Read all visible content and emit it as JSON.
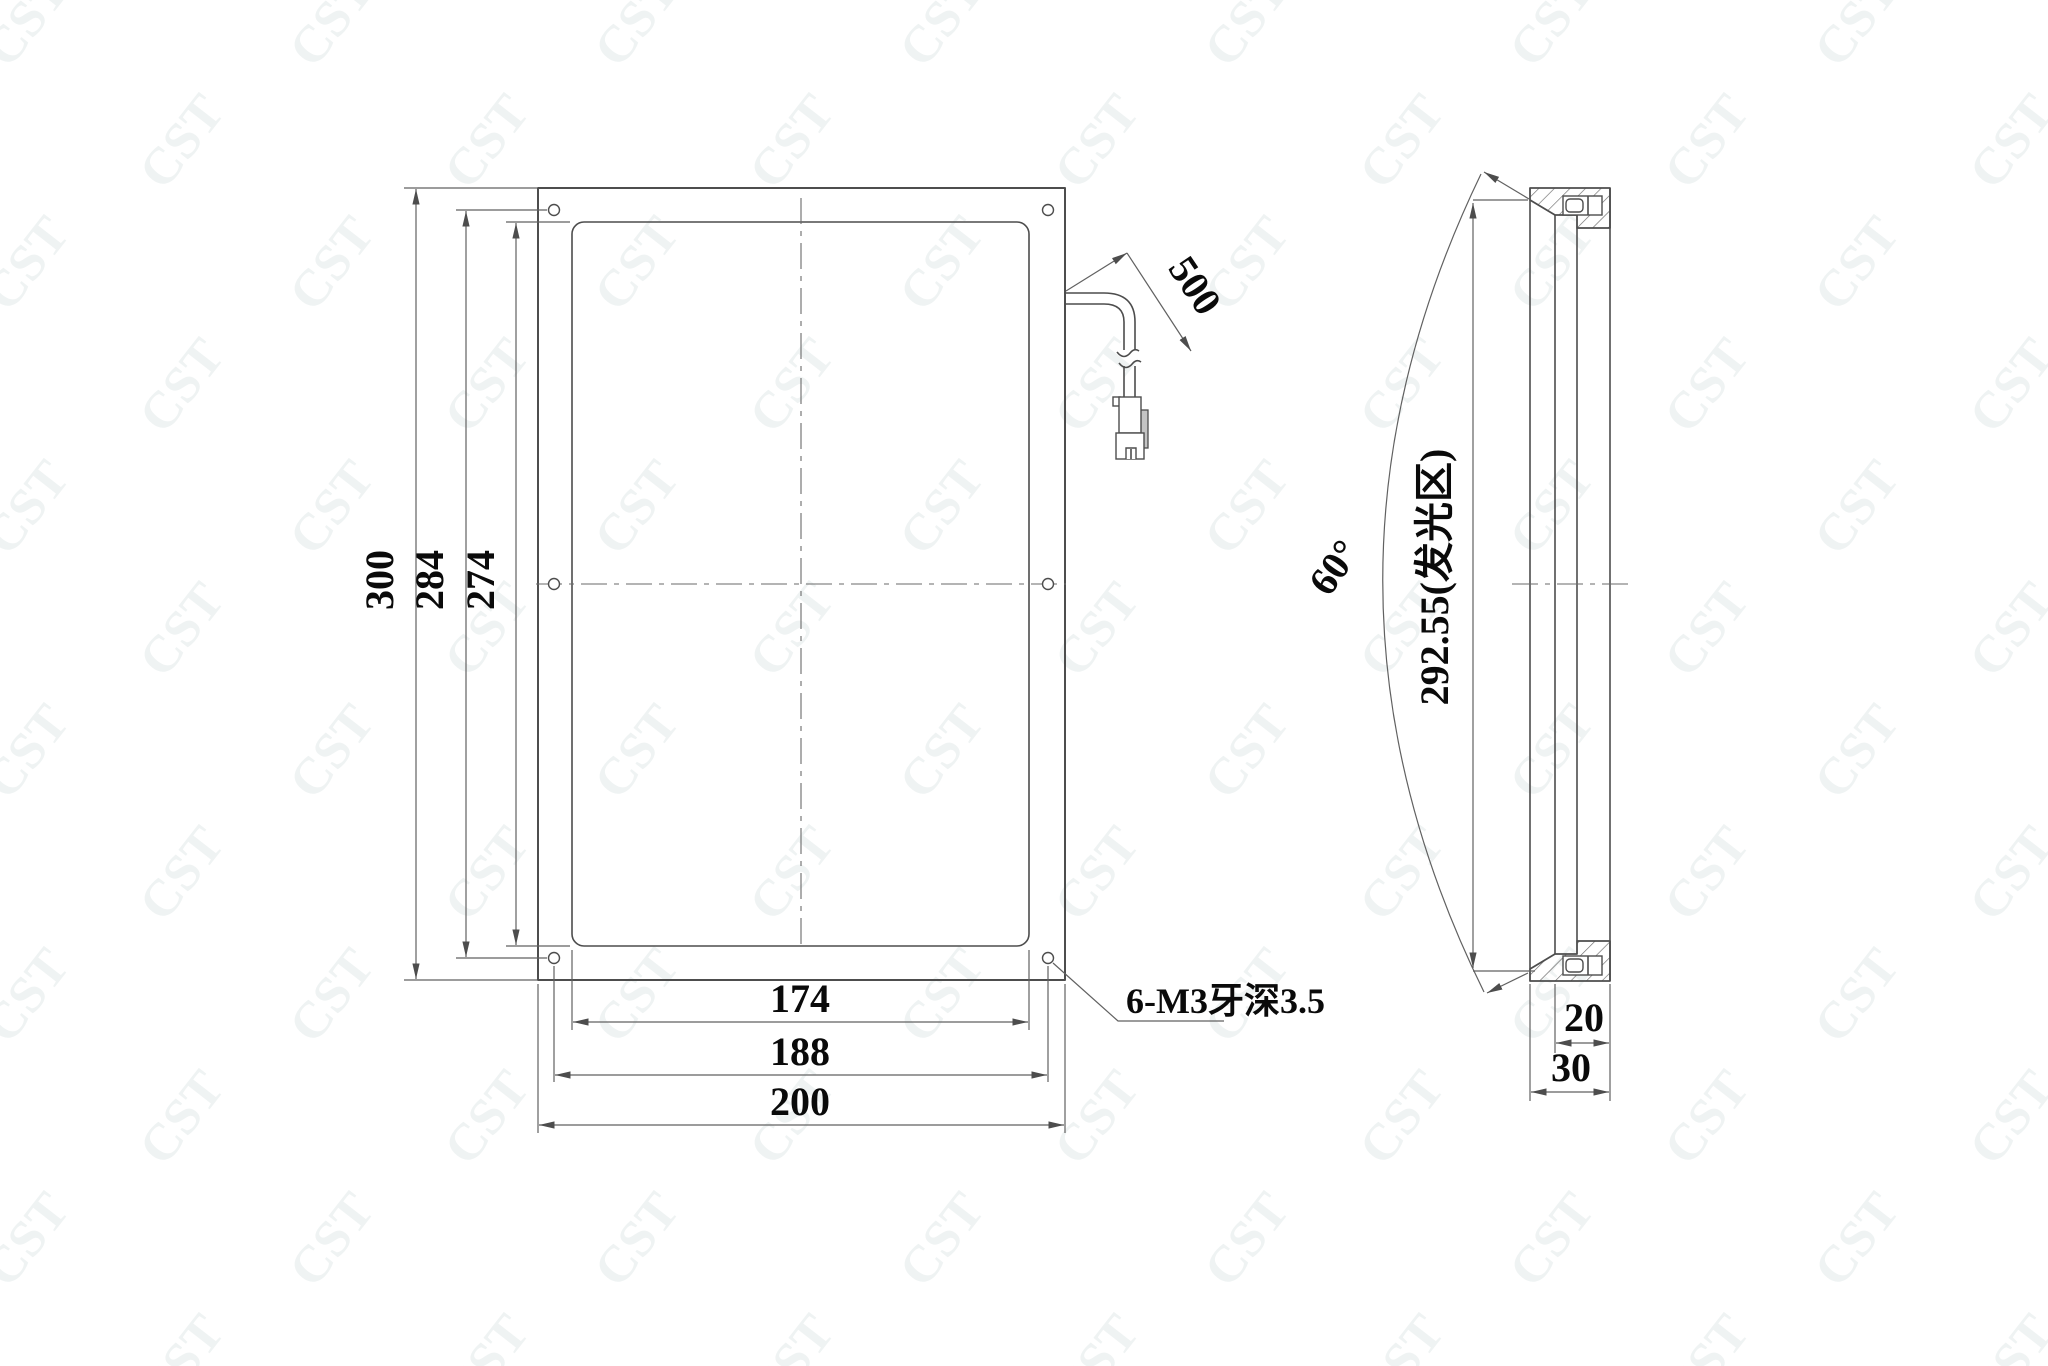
{
  "drawing": {
    "watermark_text": "CST",
    "colors": {
      "object_line": "#4d4d4d",
      "thin_line": "#616161",
      "text": "#0a0a0a",
      "watermark": "#eff3f3",
      "background": "#ffffff"
    }
  },
  "front_view": {
    "dim_height_outer": "300",
    "dim_height_holes": "284",
    "dim_height_luminous": "274",
    "dim_width_luminous": "174",
    "dim_width_holes": "188",
    "dim_width_outer": "200",
    "cable_length": "500",
    "mounting_note": "6-M3牙深3.5"
  },
  "side_view": {
    "luminous_height": "292.55(发光区)",
    "beam_angle": "60°",
    "dim_depth_inner": "20",
    "dim_depth_total": "30"
  }
}
